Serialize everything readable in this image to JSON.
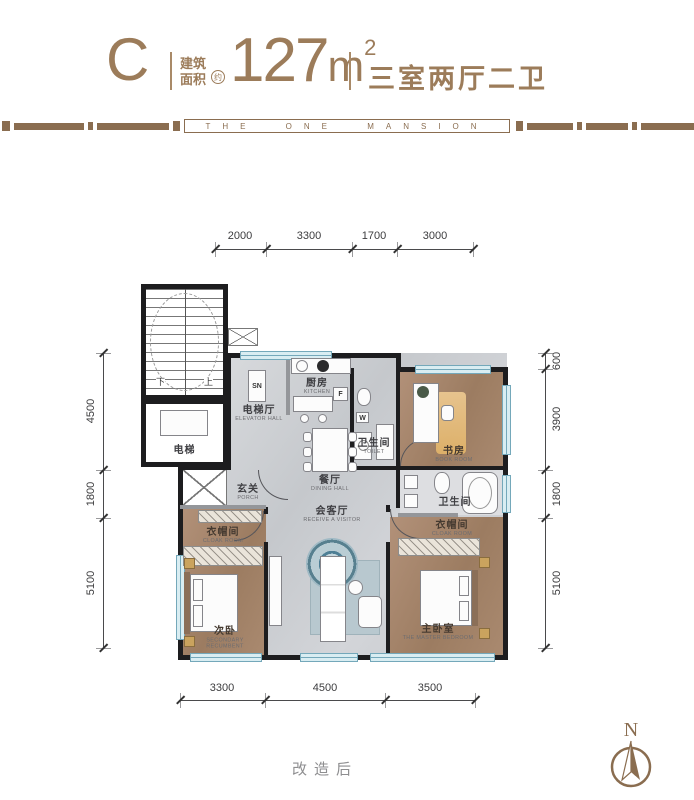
{
  "header": {
    "type_letter": "C",
    "area_label_top": "建筑",
    "area_label_bottom": "面积",
    "approx_mark": "约",
    "area_value": "127",
    "area_unit": "m",
    "area_sup": "2",
    "layout_desc": "三室两厅二卫"
  },
  "band": {
    "text": "THE ONE MANSION"
  },
  "rooms": {
    "elevator_hall": {
      "cn": "电梯厅",
      "en": "ELEVATOR HALL"
    },
    "elevator": {
      "cn": "电梯"
    },
    "stair_down": "下",
    "stair_up": "上",
    "sn": "SN",
    "fridge": "F",
    "washer": "W",
    "kitchen": {
      "cn": "厨房",
      "en": "KITCHEN"
    },
    "toilet_guest": {
      "cn": "卫生间",
      "en": "TOILET"
    },
    "book_room": {
      "cn": "书房",
      "en": "BOOK ROOM"
    },
    "dining": {
      "cn": "餐厅",
      "en": "DINING HALL"
    },
    "porch": {
      "cn": "玄关",
      "en": "PORCH"
    },
    "living": {
      "cn": "会客厅",
      "en": "RECEIVE A VISITOR"
    },
    "cloak_left": {
      "cn": "衣帽间",
      "en": "CLOAK ROOM"
    },
    "secondary_bedroom": {
      "cn": "次卧",
      "en": "SECONDARY RECUMBENT"
    },
    "master_bath": {
      "cn": "卫生间",
      "en": "TOILET"
    },
    "cloak_right": {
      "cn": "衣帽间",
      "en": "CLOAK ROOM"
    },
    "master_bedroom": {
      "cn": "主卧室",
      "en": "THE MASTER BEDROOM"
    }
  },
  "dimensions": {
    "top": [
      "2000",
      "3300",
      "1700",
      "3000"
    ],
    "bottom": [
      "3300",
      "4500",
      "3500"
    ],
    "left": [
      "4500",
      "1800",
      "5100"
    ],
    "right": [
      "600",
      "3900",
      "1800",
      "5100"
    ]
  },
  "footer": {
    "note": "改造后",
    "compass": "N"
  },
  "colors": {
    "brand": "#9c7c5a"
  }
}
